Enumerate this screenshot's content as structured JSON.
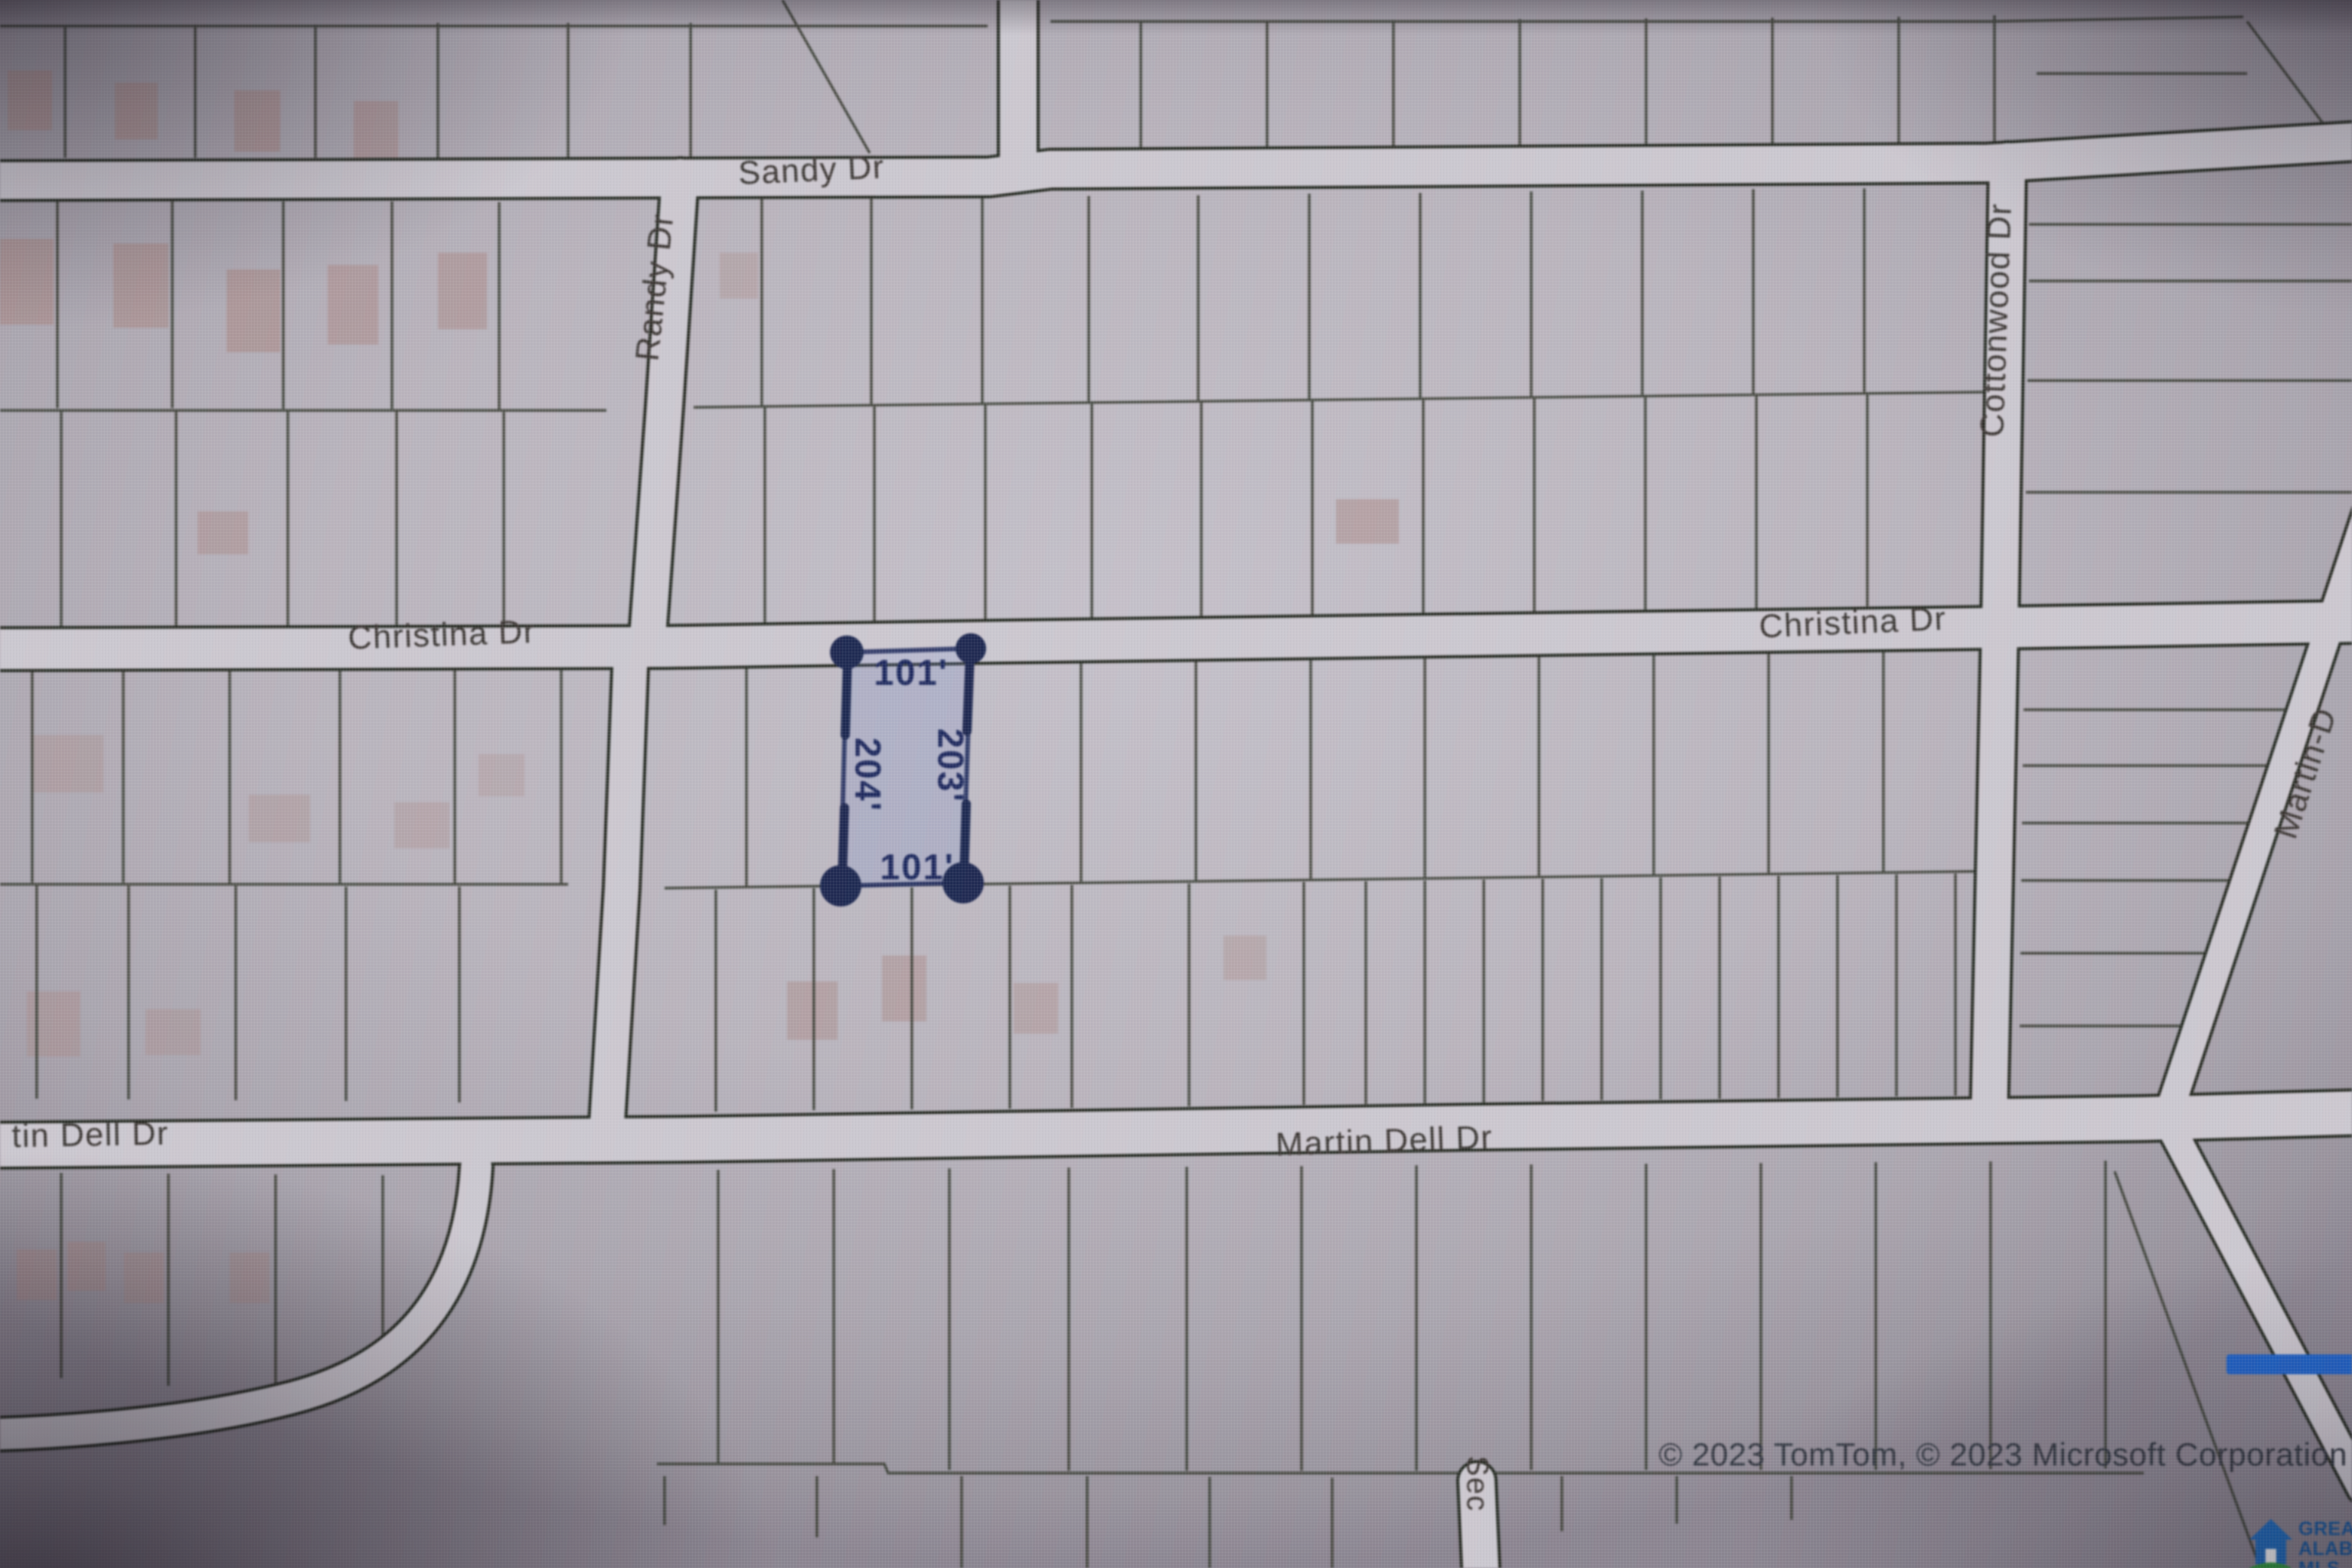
{
  "map": {
    "streets": {
      "sandy": "Sandy Dr",
      "randy": "Randy Dr",
      "cottonwood": "Cottonwood Dr",
      "christina_left": "Christina Dr",
      "christina_right": "Christina Dr",
      "martin_dell_left_partial": "tin Dell Dr",
      "martin_dell_center": "Martin Dell Dr",
      "martin_right_partial": "Martin-D",
      "sec_partial": "Sec"
    },
    "highlighted_parcel": {
      "dim_top": "101'",
      "dim_right": "203'",
      "dim_left": "204'",
      "dim_bottom": "101'",
      "marker_color": "#1d2850",
      "fill_tint": "#6982d2"
    },
    "attribution": "© 2023 TomTom, © 2023 Microsoft Corporation",
    "logo": {
      "line1": "GREATER",
      "line2": "ALABAMA",
      "line3": "MLS",
      "house_color": "#1c6cc0",
      "swoosh_color": "#2f9e3e",
      "text_color": "#1459a0"
    },
    "colors": {
      "parcel_background": "#bab5bd",
      "road_fill": "#cdc9d0",
      "road_edge": "#262b22",
      "lot_line": "#3a3e33",
      "house_footprint": "#a8837e",
      "street_label": "#3b3733",
      "highlight_blue_bar": "#1f63c9"
    }
  }
}
